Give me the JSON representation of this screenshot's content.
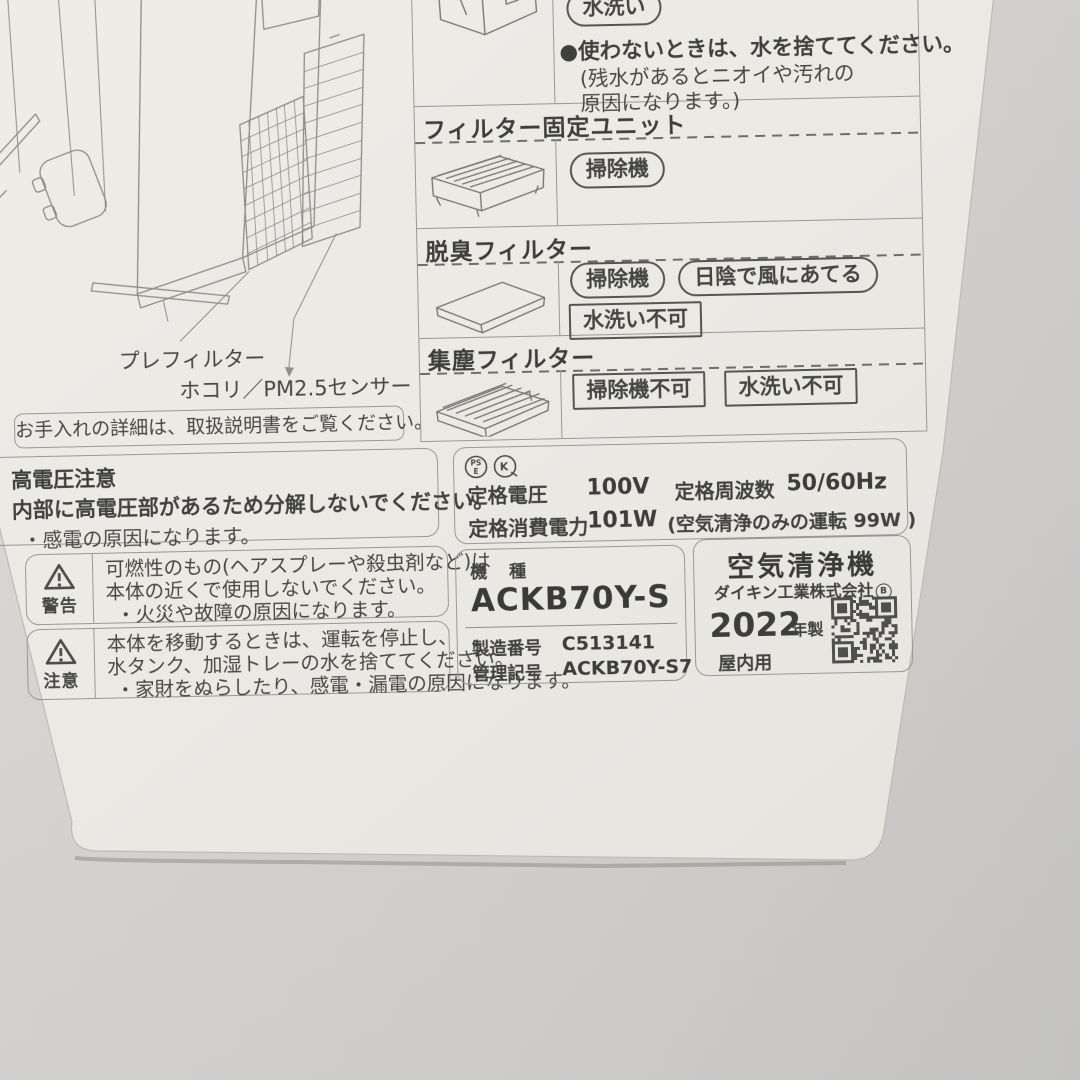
{
  "photo": {
    "subject": "air purifier maintenance and specification label"
  },
  "care": {
    "washable_row": {
      "badge": "水洗い",
      "bullet": "●",
      "point": "使わないときは、水を捨ててください。",
      "note_line1": "(残水があるとニオイや汚れの",
      "note_line2": "原因になります。)"
    },
    "rows": [
      {
        "title": "フィルター固定ユニット",
        "methods": [
          "掃除機"
        ]
      },
      {
        "title": "脱臭フィルター",
        "methods": [
          "掃除機",
          "日陰で風にあてる"
        ],
        "prohibited": [
          "水洗い不可"
        ]
      },
      {
        "title": "集塵フィルター",
        "prohibited": [
          "掃除機不可",
          "水洗い不可"
        ]
      }
    ]
  },
  "diagram": {
    "part_label_prefilter": "プレフィルター",
    "part_label_sensor": "ホコリ／PM2.5センサー",
    "note": "お手入れの詳細は、取扱説明書をご覧ください。"
  },
  "high_voltage": {
    "title": "高電圧注意",
    "line1": "内部に高電圧部があるため分解しないでください。",
    "line2": "・感電の原因になります。"
  },
  "warning": {
    "label": "警告",
    "line1": "可燃性のもの(ヘアスプレーや殺虫剤など)は",
    "line2": "本体の近くで使用しないでください。",
    "line3": "・火災や故障の原因になります。"
  },
  "caution": {
    "label": "注意",
    "line1": "本体を移動するときは、運転を停止し、",
    "line2": "水タンク、加湿トレーの水を捨ててください。",
    "line3": "・家財をぬらしたり、感電・漏電の原因になります。"
  },
  "ratings": {
    "mark1": "PS E",
    "mark2": "K",
    "voltage_label": "定格電圧",
    "voltage_value": "100V",
    "frequency_label": "定格周波数",
    "frequency_value": "50/60Hz",
    "power_label": "定格消費電力",
    "power_value": "101W",
    "power_note": "(空気清浄のみの運転 99W )"
  },
  "model": {
    "label": "機 種",
    "name": "ACKB70Y-S",
    "serial_label": "製造番号",
    "serial": "C513141",
    "code_label": "管理記号",
    "code": "ACKB70Y-S7"
  },
  "brand": {
    "product": "空気清浄機",
    "company": "ダイキン工業株式会社",
    "company_mark": "B",
    "year": "2022",
    "year_suffix": "年製",
    "usage": "屋内用"
  },
  "colors": {
    "label_bg": "#ecebe5",
    "surface_bg": "#d6d4d1",
    "ink": "#454543",
    "line": "#9a9896"
  }
}
